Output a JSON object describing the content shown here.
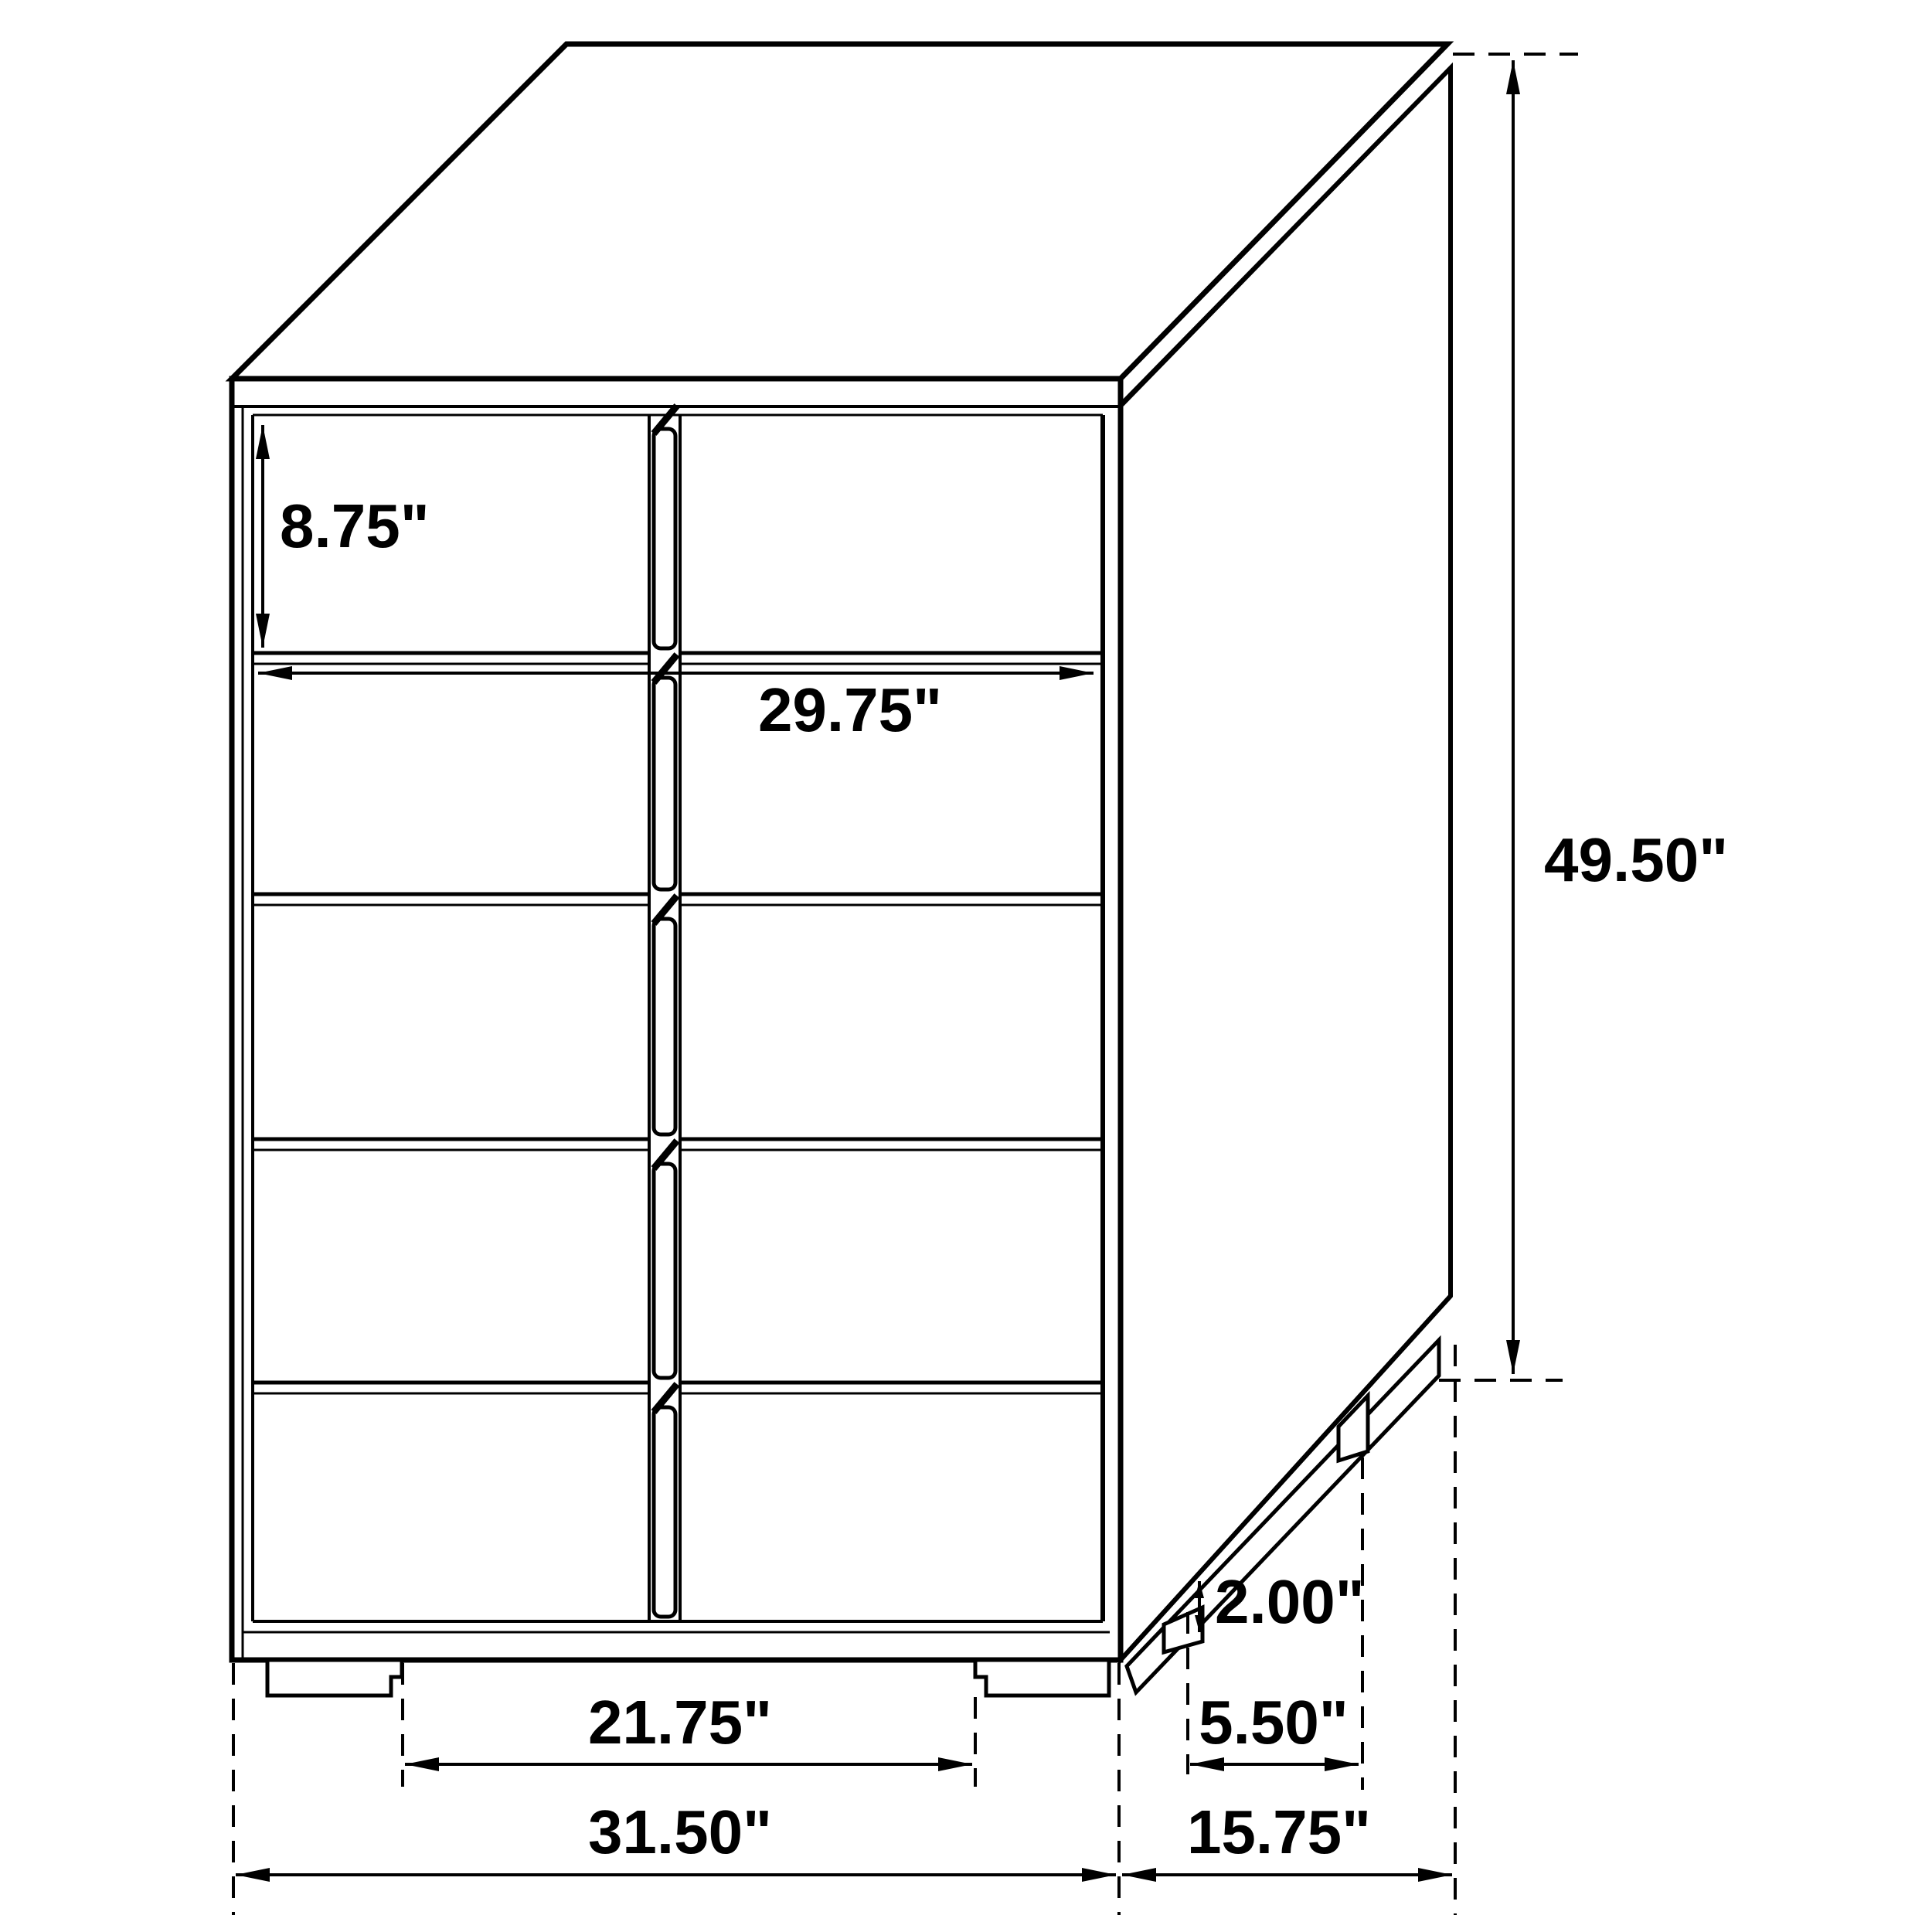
{
  "drawing": {
    "title": "chest-of-drawers-dimension-diagram",
    "subject": "5-drawer chest, three-quarter line view with dimension callouts",
    "background_color": "#ffffff",
    "line_color": "#000000",
    "units": "inches",
    "labels": {
      "drawer_height": "8.75\"",
      "interior_width": "29.75\"",
      "overall_height": "49.50\"",
      "foot_height": "2.00\"",
      "foot_depth": "5.50\"",
      "front_feet_span": "21.75\"",
      "overall_width": "31.50\"",
      "overall_depth": "15.75\""
    }
  }
}
